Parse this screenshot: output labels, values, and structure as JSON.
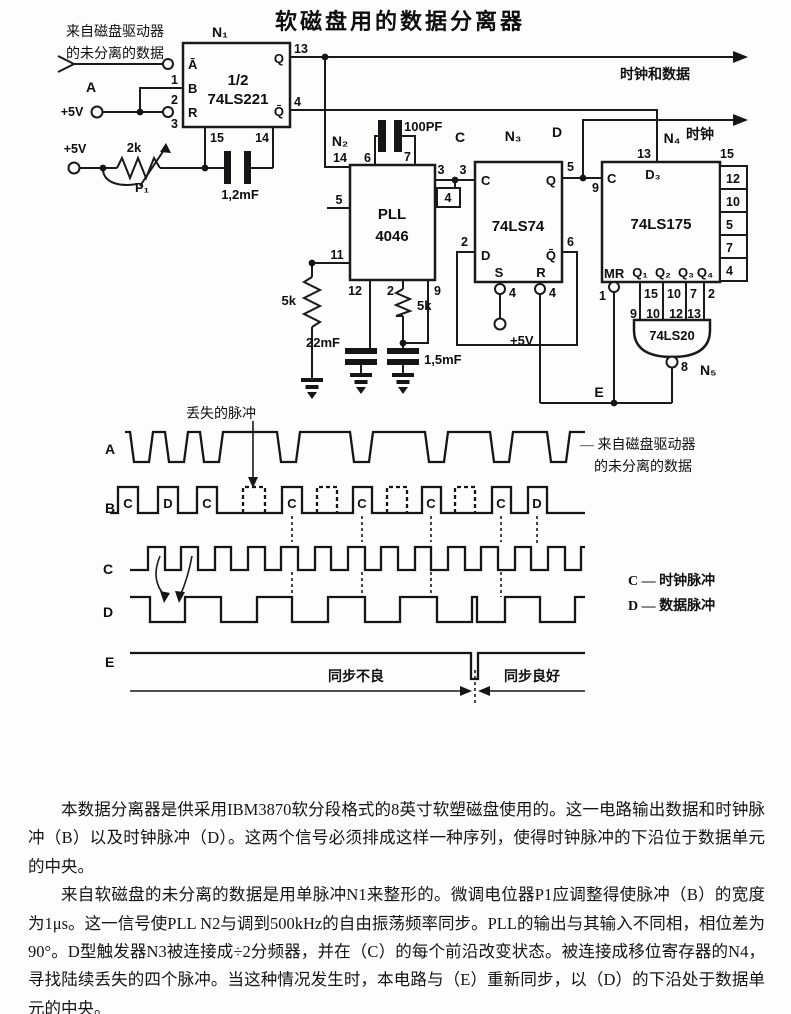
{
  "title": "软磁盘用的数据分离器",
  "schematic": {
    "source_note_line1": "来自磁盘驱动器",
    "source_note_line2": "的未分离的数据",
    "label_a": "A",
    "v5_input": "+5V",
    "v5_pot": "+5V",
    "v5_n3": "+5V",
    "out_clock_data": "时钟和数据",
    "out_clock": "时钟",
    "node_c": "C",
    "node_d": "D",
    "node_e": "E",
    "pot": {
      "value": "2k",
      "name": "P₁"
    },
    "cap_12mf": "1,2mF",
    "cap_100pf": "100PF",
    "cap_22mf": "22mF",
    "cap_15mf": "1,5mF",
    "r5k_left": "5k",
    "r5k_right": "5k",
    "n1": {
      "name": "N₁",
      "half": "1/2",
      "chip": "74LS221",
      "pin_abar": "Ā",
      "pin_b": "B",
      "pin_r": "R",
      "pin_q": "Q",
      "pin_qbar": "Q̄",
      "num1": "1",
      "num2": "2",
      "num3": "3",
      "num13": "13",
      "num4": "4",
      "num15": "15",
      "num14": "14"
    },
    "n2": {
      "name": "N₂",
      "chip1": "PLL",
      "chip2": "4046",
      "num6": "6",
      "num7": "7",
      "num14": "14",
      "num5": "5",
      "num11": "11",
      "num3": "3",
      "num4": "4",
      "num12": "12",
      "num2": "2",
      "num9": "9"
    },
    "n3": {
      "name": "N₃",
      "chip": "74LS74",
      "pin_c": "C",
      "pin_q": "Q",
      "pin_d": "D",
      "pin_qbar": "Q̄",
      "pin_s": "S",
      "pin_r": "R",
      "num3": "3",
      "num5": "5",
      "num2": "2",
      "num6": "6",
      "num_s": "4",
      "num_r": "4"
    },
    "n4": {
      "name": "N₄",
      "chip": "74LS175",
      "pin_c": "C",
      "pin_d3": "D₃",
      "pin_mr": "MR",
      "q1": "Q₁",
      "q2": "Q₂",
      "q3": "Q₃",
      "q4": "Q₄",
      "num13": "13",
      "num9": "9",
      "num15top": "15",
      "num1": "1",
      "numq1": "15",
      "numq2": "10",
      "numq3": "7",
      "numq4": "2",
      "ladder": [
        "12",
        "10",
        "5",
        "7",
        "4"
      ]
    },
    "n5": {
      "name": "N₅",
      "chip": "74LS20",
      "in1": "9",
      "in2": "10",
      "in3": "12",
      "in4": "13",
      "num8": "8"
    }
  },
  "waveforms": {
    "lost_pulse_label": "丢失的脉冲",
    "row_a": "A",
    "row_b": "B",
    "row_c": "C",
    "row_d": "D",
    "row_e": "E",
    "b_letters": [
      "C",
      "D",
      "C",
      "C",
      "C",
      "C",
      "C",
      "D"
    ],
    "a_note_line1": "— 来自磁盘驱动器",
    "a_note_line2": "的未分离的数据",
    "legend_c": "C — 时钟脉冲",
    "legend_d": "D — 数据脉冲",
    "sync_bad": "同步不良",
    "sync_good": "同步良好"
  },
  "paragraphs": [
    "本数据分离器是供采用IBM3870软分段格式的8英寸软塑磁盘使用的。这一电路输出数据和时钟脉冲（B）以及时钟脉冲（D）。这两个信号必须排成这样一种序列，使得时钟脉冲的下沿位于数据单元的中央。",
    "来自软磁盘的未分离的数据是用单脉冲N1来整形的。微调电位器P1应调整得使脉冲（B）的宽度为1μs。这一信号使PLL N2与调到500kHz的自由振荡频率同步。PLL的输出与其输入不同相，相位差为90°。D型触发器N3被连接成÷2分频器，并在（C）的每个前沿改变状态。被连接成移位寄存器的N4，寻找陆续丢失的四个脉冲。当这种情况发生时，本电路与（E）重新同步，以（D）的下沿处于数据单元的中央。"
  ]
}
